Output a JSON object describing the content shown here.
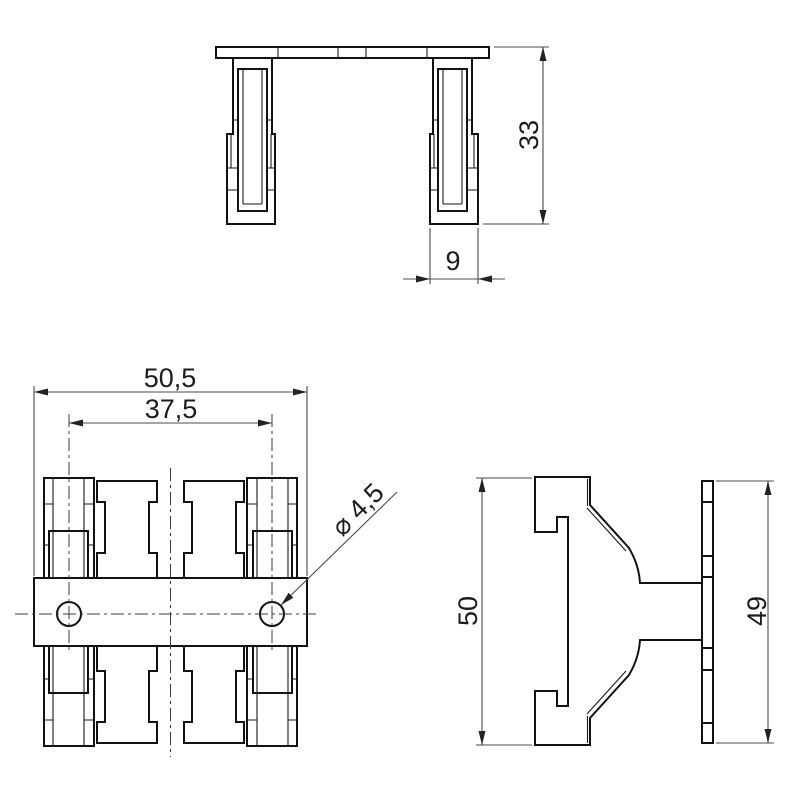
{
  "drawing": {
    "type": "technical-drawing",
    "background": "#ffffff",
    "colors": {
      "object_line": "#121212",
      "dimension_line": "#4b4b4b",
      "centerline": "#3c3c3c",
      "text": "#1c1c1c"
    },
    "views": {
      "top": {
        "name": "top view",
        "dims": {
          "height": {
            "label": "33"
          },
          "foot_width": {
            "label": "9"
          }
        }
      },
      "front": {
        "name": "front view",
        "dims": {
          "overall_width": {
            "label": "50,5"
          },
          "hole_spacing": {
            "label": "37,5"
          },
          "hole_diameter": {
            "label": "⌀ 4,5"
          }
        }
      },
      "side": {
        "name": "side view",
        "dims": {
          "body_height": {
            "label": "50"
          },
          "plate_height": {
            "label": "49"
          }
        }
      }
    }
  }
}
